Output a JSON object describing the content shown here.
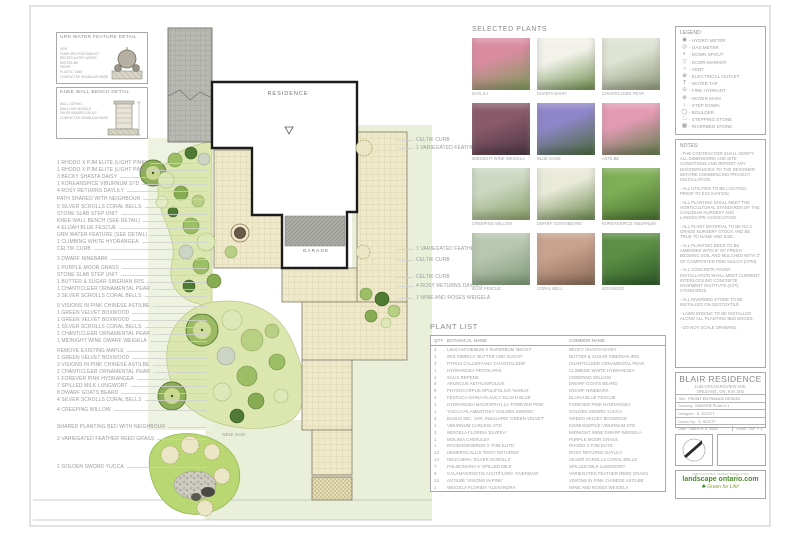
{
  "details": {
    "urn": {
      "title": "URN WATER FEATURE DETAIL",
      "labels": [
        "URN",
        "PUMP AND FOUNTAIN KIT",
        "RECIRCULATED WATER",
        "WATERLINE",
        "PAVER",
        "PLASTIC TANK",
        "COMPACTED GRANULAR BASE"
      ]
    },
    "bench": {
      "title": "KNEE WALL BENCH DETAIL",
      "labels": [
        "WALL COPING",
        "WALL UNIT MODULE",
        "PAVER BANDED GROUT",
        "COMPACTED GRANULAR BASE"
      ]
    }
  },
  "plan": {
    "residence_label": "RESIDENCE",
    "garage_label": "GARAGE",
    "new_sod_label": "NEW SOD",
    "callouts_left": [
      {
        "text": "1 RHODO X PJM ELITE (LIGHT PINK)",
        "top": 160
      },
      {
        "text": "1 RHODO X PJM ELITE (LIGHT PINK)",
        "top": 167
      },
      {
        "text": "3 BECKY SHASTA DAISY",
        "top": 174
      },
      {
        "text": "1 KOREANSPICE VIBURNUM STD",
        "top": 181
      },
      {
        "text": "4 ROSY RETURNS DAYLILY",
        "top": 188
      },
      {
        "text": "PATH SHARED WITH NEIGHBOUR",
        "top": 196
      },
      {
        "text": "5 SILVER SCROLLS CORAL BELLS",
        "top": 204
      },
      {
        "text": "STONE SLAB STEP UNIT",
        "top": 211
      },
      {
        "text": "KNEE WALL BENCH (SEE DETAIL)",
        "top": 218
      },
      {
        "text": "4 ELIJAH BLUE FESCUE",
        "top": 225
      },
      {
        "text": "URN WATER FEATURE (SEE DETAIL)",
        "top": 232
      },
      {
        "text": "1 CLIMBING WHITE HYDRANGEA",
        "top": 239
      },
      {
        "text": "CELTIK CURB",
        "top": 246
      },
      {
        "text": "3 DWARF NINEBARK",
        "top": 256
      },
      {
        "text": "1 PURPLE MOOR GRASS",
        "top": 265
      },
      {
        "text": "STONE SLAB STEP UNIT",
        "top": 272
      },
      {
        "text": "1 BUTTER & SUGAR SIBERIAN IRIS",
        "top": 279
      },
      {
        "text": "1 CHANTICLEER ORNAMENTAL PEAR",
        "top": 286
      },
      {
        "text": "3 SILVER SCROLLS CORAL BELLS",
        "top": 293
      },
      {
        "text": "9 VISIONS IN PINK CHINESE ASTILBE",
        "top": 303
      },
      {
        "text": "1 GREEN VELVET BOXWOOD",
        "top": 310
      },
      {
        "text": "1 GREEN VELVET BOXWOOD",
        "top": 317
      },
      {
        "text": "1 SILVER SCROLLS CORAL BELLS",
        "top": 324
      },
      {
        "text": "1 CHANTICLEER ORNAMENTAL PEAR",
        "top": 331
      },
      {
        "text": "1 MIDNIGHT WINE DWARF WEIGELA",
        "top": 338
      },
      {
        "text": "REMOVE EXISTING MAPLE",
        "top": 348
      },
      {
        "text": "1 GREEN VELVET BOXWOOD",
        "top": 355
      },
      {
        "text": "3 VISIONS IN PINK CHINESE ASTILBE",
        "top": 362
      },
      {
        "text": "1 CHANTICLEER ORNAMENTAL PEAR",
        "top": 369
      },
      {
        "text": "1 FOREVER PINK HYDRANGEA",
        "top": 376
      },
      {
        "text": "7 SPILLED MILK LUNGWORT",
        "top": 383
      },
      {
        "text": "8 DWARF GOATS BEARD",
        "top": 390
      },
      {
        "text": "4 SILVER SCROLLS CORAL BELLS",
        "top": 397
      },
      {
        "text": "4 CREEPING WILLOW",
        "top": 407
      },
      {
        "text": "SHARED PLANTING BED WITH NEIGHBOUR",
        "top": 424
      },
      {
        "text": "3 VARIEGATED FEATHER REED GRASS",
        "top": 436
      },
      {
        "text": "1 GOLDEN SWORD YUCCA",
        "top": 464
      }
    ],
    "callouts_right": [
      {
        "text": "CELTIK CURB",
        "top": 137
      },
      {
        "text": "1 VARIEGATED FEATHER REED GRASS",
        "top": 145
      },
      {
        "text": "1 VARIEGATED FEATHER REED GRASS",
        "top": 246
      },
      {
        "text": "CELTIK CURB",
        "top": 257
      },
      {
        "text": "CELTIK CURB",
        "top": 274
      },
      {
        "text": "4 ROSY RETURNS DAYLILY",
        "top": 283
      },
      {
        "text": "1 WINE AND ROSES WEIGELA",
        "top": 295
      }
    ]
  },
  "selected_plants": {
    "title": "SELECTED PLANTS",
    "items": [
      {
        "label": "DAYLILY",
        "c1": "#d98ca0",
        "c2": "#7c9a5a"
      },
      {
        "label": "SHASTA DAISY",
        "c1": "#f2f2ea",
        "c2": "#6f8f4f"
      },
      {
        "label": "CHANTICLEER PEAR",
        "c1": "#dfe3d3",
        "c2": "#8e9a7a"
      },
      {
        "label": "MIDNIGHT WINE WEIGELA",
        "c1": "#8a5a6a",
        "c2": "#4a3642"
      },
      {
        "label": "BLUE SAGE",
        "c1": "#8f86c9",
        "c2": "#4a6b3a"
      },
      {
        "label": "ASTILBE",
        "c1": "#e39bb4",
        "c2": "#5f7d4a"
      },
      {
        "label": "CREEPING WILLOW",
        "c1": "#cdd8c2",
        "c2": "#8aa06a"
      },
      {
        "label": "DWARF GOATSBEARD",
        "c1": "#e9ead8",
        "c2": "#6d8a50"
      },
      {
        "label": "KOREANSPICE VIBURNUM",
        "c1": "#7fae57",
        "c2": "#48702f"
      },
      {
        "label": "BLUE FESCUE",
        "c1": "#b9c7b0",
        "c2": "#7e9a78"
      },
      {
        "label": "CORAL BELL",
        "c1": "#c9a28e",
        "c2": "#8a6a58"
      },
      {
        "label": "BOXWOOD",
        "c1": "#5d8f45",
        "c2": "#2f5a28"
      }
    ]
  },
  "plant_list": {
    "title": "PLANT LIST",
    "columns": {
      "qty": "QTY",
      "botanical": "BOTANICAL NAME",
      "common": "COMMON NAME"
    },
    "rows": [
      {
        "qty": "3",
        "botanical": "LEUCANTHEMUM X SUPERBUM 'BECKY'",
        "common": "BECKY SHASTA DAISY"
      },
      {
        "qty": "1",
        "botanical": "IRIS SIBIRICA 'BUTTER AND SUGAR'",
        "common": "BUTTER & SUGAR SIBERIAN IRIS"
      },
      {
        "qty": "3",
        "botanical": "PYRUS CALLERYANA 'CHANTICLEER'",
        "common": "CHANTICLEER ORNAMENTAL PEAR"
      },
      {
        "qty": "1",
        "botanical": "HYDRANGEA PETIOLARIS",
        "common": "CLIMBING WHITE HYDRANGEA"
      },
      {
        "qty": "4",
        "botanical": "SALIX REPENS",
        "common": "CREEPING WILLOW"
      },
      {
        "qty": "8",
        "botanical": "ARUNCUS AETHUSIFOLIUS",
        "common": "DWARF GOATS BEARD"
      },
      {
        "qty": "9",
        "botanical": "PHYSOCARPUS OPULIFOLIUS 'NANUS'",
        "common": "DWARF NINEBARK"
      },
      {
        "qty": "4",
        "botanical": "FESTUCA OVINA GLAUCA 'ELIJAH BLUE'",
        "common": "ELIJAH BLUE FESCUE"
      },
      {
        "qty": "1",
        "botanical": "HYDRANGEA MACROPHYLLA 'FOREVER PINK'",
        "common": "FOREVER PINK HYDRANGEA"
      },
      {
        "qty": "1",
        "botanical": "YUCCA FILAMENTOSA 'GOLDEN SWORD'",
        "common": "GOLDEN SWORD YUCCA"
      },
      {
        "qty": "3",
        "botanical": "BUXUS MIC. VAR. INSULARIS 'GREEN VELVET'",
        "common": "GREEN VELVET BOXWOOD"
      },
      {
        "qty": "1",
        "botanical": "VIBURNUM CARLESII STD",
        "common": "KOREANSPICE VIBURNUM STD"
      },
      {
        "qty": "3",
        "botanical": "WEIGELA FLORIDA 'ELVERA'",
        "common": "MIDNIGHT WINE DWARF WEIGELA"
      },
      {
        "qty": "1",
        "botanical": "MOLINIA CAERULEA",
        "common": "PURPLE MOOR GRASS"
      },
      {
        "qty": "1",
        "botanical": "RHODODENDRON X 'PJM ELITE'",
        "common": "RHODO X PJM ELITE"
      },
      {
        "qty": "12",
        "botanical": "HEMEROCALLIS 'ROSY RETURNS'",
        "common": "ROSY RETURNS DAYLILY"
      },
      {
        "qty": "14",
        "botanical": "HEUCHERA 'SILVER SCROLLS'",
        "common": "SILVER SCROLLS CORAL BELLS"
      },
      {
        "qty": "7",
        "botanical": "PULMONARIA X 'SPILLED MILK'",
        "common": "SPILLED MILK LUNGWORT"
      },
      {
        "qty": "5",
        "botanical": "CALAMAGROSTIS ACUTIFLORA 'OVERDAM'",
        "common": "VARIEGATED FEATHER REED GRASS"
      },
      {
        "qty": "12",
        "botanical": "ASTILBE 'VISIONS IN PINK'",
        "common": "VISIONS IN PINK CHINESE ASTILBE"
      },
      {
        "qty": "1",
        "botanical": "WEIGELA FLORIDA 'ALEXANDRA'",
        "common": "WINE AND ROSES WEIGELA"
      }
    ]
  },
  "legend": {
    "title": "LEGEND:",
    "items": [
      {
        "icon": "◉",
        "label": "- HYDRO METER"
      },
      {
        "icon": "◎",
        "label": "- GAS METER"
      },
      {
        "icon": "◐",
        "label": "- DOWN SPOUT"
      },
      {
        "icon": "▽",
        "label": "- DOOR MARKER"
      },
      {
        "icon": "○",
        "label": "- VENT"
      },
      {
        "icon": "⊕",
        "label": "- ELECTRICAL OUTLET"
      },
      {
        "icon": "T",
        "label": "- WATER TAP"
      },
      {
        "icon": "⊙",
        "label": "- FIRE HYDRANT"
      },
      {
        "icon": "⊗",
        "label": "- WATER MAIN"
      },
      {
        "icon": "↓",
        "label": "- STEP DOWN"
      },
      {
        "icon": "◯",
        "label": "- BOULDER"
      },
      {
        "icon": "□",
        "label": "- STEPPING STONE"
      },
      {
        "icon": "▦",
        "label": "- RIVERBED STONE"
      }
    ]
  },
  "notes": {
    "title": "NOTES:",
    "items": [
      "- THE CONTRACTOR SHALL VERIFY ALL DIMENSIONS AND SITE CONDITIONS AND REPORT ANY DISCREPANCIES TO THE DESIGNER BEFORE COMMENCING PROJECT INSTALLATION.",
      "- ALL UTILITIES TO BE LOCATED PRIOR TO EXCAVATION.",
      "- ALL PLANTING SHALL MEET THE HORTICULTURAL STANDARDS OF THE CANADIAN NURSERY AND LANDSCAPE ASSOCIATION.",
      "- ALL PLANT MATERIAL TO BE NO.1 GRADE NURSERY STOCK AND BE TRUE TO NAME AND SIZE.",
      "- ALL PLANTING BEDS TO BE AMENDED WITH 8\" OF FRESH BEDDING SOIL AND MULCHED WITH 3\" OF COMPOSTED PINE MULCH (CPM).",
      "- ALL CONCRETE PAVER INSTALLATION SHALL MEET CURRENT INTERLOCKING CONCRETE PAVEMENT INSTITUTE (ICPI) STANDARDS.",
      "- ALL RIVERBED STONE TO BE INSTALLED ON GEOTEXTILE.",
      "- LAWN EDGING TO BE INSTALLED ALONG ALL PLANTING BED EDGES.",
      "- DO NOT SCALE DRAWING."
    ]
  },
  "title_block": {
    "name": "BLAIR RESIDENCE",
    "address1": "1155 ORCHARDVIEW AVE.",
    "address2": "ORLEANS, ON, K4A 3H2",
    "rows": [
      {
        "label": "Title:",
        "value": "FRONT ENTRANCE DESIGN"
      },
      {
        "label": "Drawing:",
        "value": "MASTER PLAN V.1"
      },
      {
        "label": "Designer:",
        "value": "S. SCOTT"
      },
      {
        "label": "Drawn By:",
        "value": "S. SCOTT"
      }
    ],
    "date_label": "Date:",
    "date": "MARCH 5, 2009",
    "scale_label": "Scale:",
    "scale": "1/4\" = 1'"
  },
  "logo": {
    "tagline_top": "HORTICULTURAL TRADES ASSOCIATION",
    "name": "landscape ontario.com",
    "tree_icon": "♣",
    "tagline": "Green for Life!",
    "brand_green": "#4a8b2c"
  }
}
